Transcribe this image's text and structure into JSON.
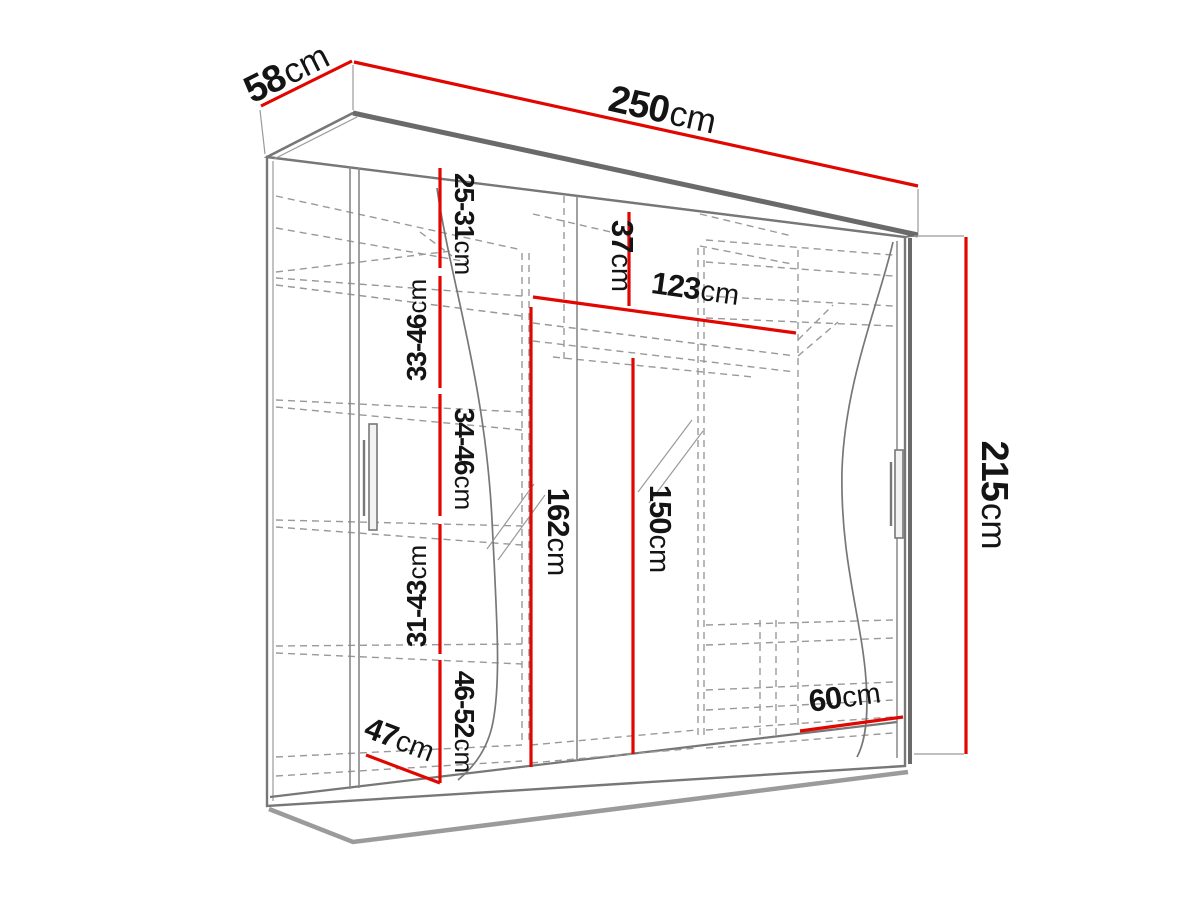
{
  "diagram_type": "wardrobe-dimension-diagram",
  "colors": {
    "dimension_red": "#e10600",
    "outline_gray": "#6e6e6e",
    "dashed_gray": "#999999",
    "label_black": "#141414",
    "background": "#ffffff"
  },
  "dimensions": {
    "depth_top": {
      "value": "58",
      "unit": "cm"
    },
    "width_top": {
      "value": "250",
      "unit": "cm"
    },
    "height_right": {
      "value": "215",
      "unit": "cm"
    },
    "shelf_gap_1": {
      "value": "25-31",
      "unit": "cm"
    },
    "shelf_gap_2": {
      "value": "33-46",
      "unit": "cm"
    },
    "shelf_gap_3": {
      "value": "34-46",
      "unit": "cm"
    },
    "shelf_gap_4": {
      "value": "31-43",
      "unit": "cm"
    },
    "shelf_gap_5": {
      "value": "46-52",
      "unit": "cm"
    },
    "top_shelf_height": {
      "value": "37",
      "unit": "cm"
    },
    "hanging_section_width": {
      "value": "123",
      "unit": "cm"
    },
    "mirror_left_height": {
      "value": "162",
      "unit": "cm"
    },
    "mirror_right_height": {
      "value": "150",
      "unit": "cm"
    },
    "right_section_width": {
      "value": "60",
      "unit": "cm"
    },
    "left_section_width": {
      "value": "47",
      "unit": "cm"
    }
  }
}
